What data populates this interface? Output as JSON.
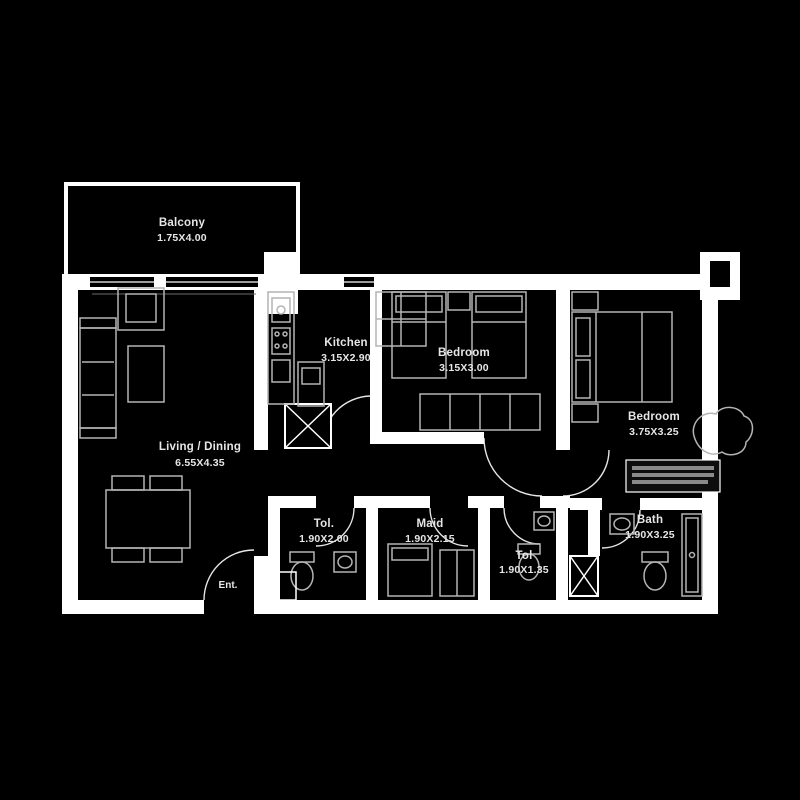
{
  "floorplan": {
    "colors": {
      "background": "#000000",
      "walls": "#ffffff",
      "furniture": "#b4b4b4",
      "text": "#e6e6e6"
    },
    "rooms": [
      {
        "name": "Balcony",
        "dims": "1.75X4.00"
      },
      {
        "name": "Living / Dining",
        "dims": "6.55X4.35"
      },
      {
        "name": "Kitchen",
        "dims": "3.15X2.90"
      },
      {
        "name": "Bedroom",
        "dims": "3.15X3.00"
      },
      {
        "name": "Bedroom",
        "dims": "3.75X3.25"
      },
      {
        "name": "Tol.",
        "dims": "1.90X2.00"
      },
      {
        "name": "Maid",
        "dims": "1.90X2.15"
      },
      {
        "name": "Tol",
        "dims": "1.90X1.35"
      },
      {
        "name": "Bath",
        "dims": "1.90X3.25"
      }
    ],
    "entrance_label": "Ent."
  }
}
